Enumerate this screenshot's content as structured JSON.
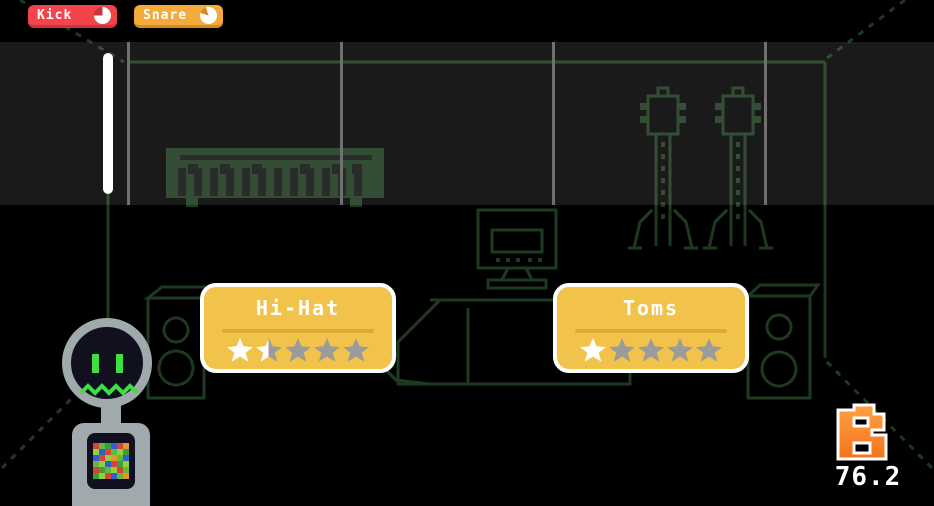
{
  "hud": {
    "tracks": [
      {
        "label": "Kick",
        "color": "#f5434c",
        "edge_color": "#c93540",
        "meter_fill": 0.75
      },
      {
        "label": "Snare",
        "color": "#f4ab3c",
        "edge_color": "#d18d27",
        "meter_fill": 0.85
      }
    ],
    "score": {
      "value": "76.2",
      "logo_letter": "B"
    }
  },
  "cards": [
    {
      "title": "Hi-Hat",
      "rating": 1.5,
      "max_stars": 5
    },
    {
      "title": "Toms",
      "rating": 1,
      "max_stars": 5
    }
  ],
  "scene": {
    "outline_color": "#1d3a20",
    "accent_green": "#3ddf42",
    "objects": [
      "piano-keyboard",
      "electric-guitar-left",
      "electric-guitar-right",
      "computer-desk",
      "speaker-left",
      "speaker-right",
      "robot-character"
    ]
  },
  "robot": {
    "mosaic": [
      [
        "#d84338",
        "#62b93e",
        "#3f9e39",
        "#2f5fd0",
        "#d84338",
        "#e2962d"
      ],
      [
        "#8fd13f",
        "#2f5fd0",
        "#d84338",
        "#62b93e",
        "#8fd13f",
        "#3f9e39"
      ],
      [
        "#2f5fd0",
        "#d84338",
        "#8fd13f",
        "#e2962d",
        "#62b93e",
        "#2f5fd0"
      ],
      [
        "#62b93e",
        "#8fd13f",
        "#2f5fd0",
        "#d84338",
        "#3f9e39",
        "#8fd13f"
      ],
      [
        "#d84338",
        "#3f9e39",
        "#62b93e",
        "#8fd13f",
        "#d84338",
        "#62b93e"
      ],
      [
        "#3f9e39",
        "#8fd13f",
        "#d84338",
        "#2f5fd0",
        "#62b93e",
        "#e2962d"
      ]
    ]
  },
  "colors": {
    "background": "#000000",
    "band_overlay": "rgba(255,255,255,0.10)",
    "grid_line": "#707070",
    "playhead": "#ffffff",
    "card_fill": "#f1c34a",
    "card_divider": "#d9a93a",
    "star_filled": "#ffffff",
    "star_empty": "#9b9b9b",
    "logo_top": "#ffa144",
    "logo_bottom": "#f4731c",
    "robot_gray": "#a0a9ab",
    "robot_dark": "#10101f"
  }
}
